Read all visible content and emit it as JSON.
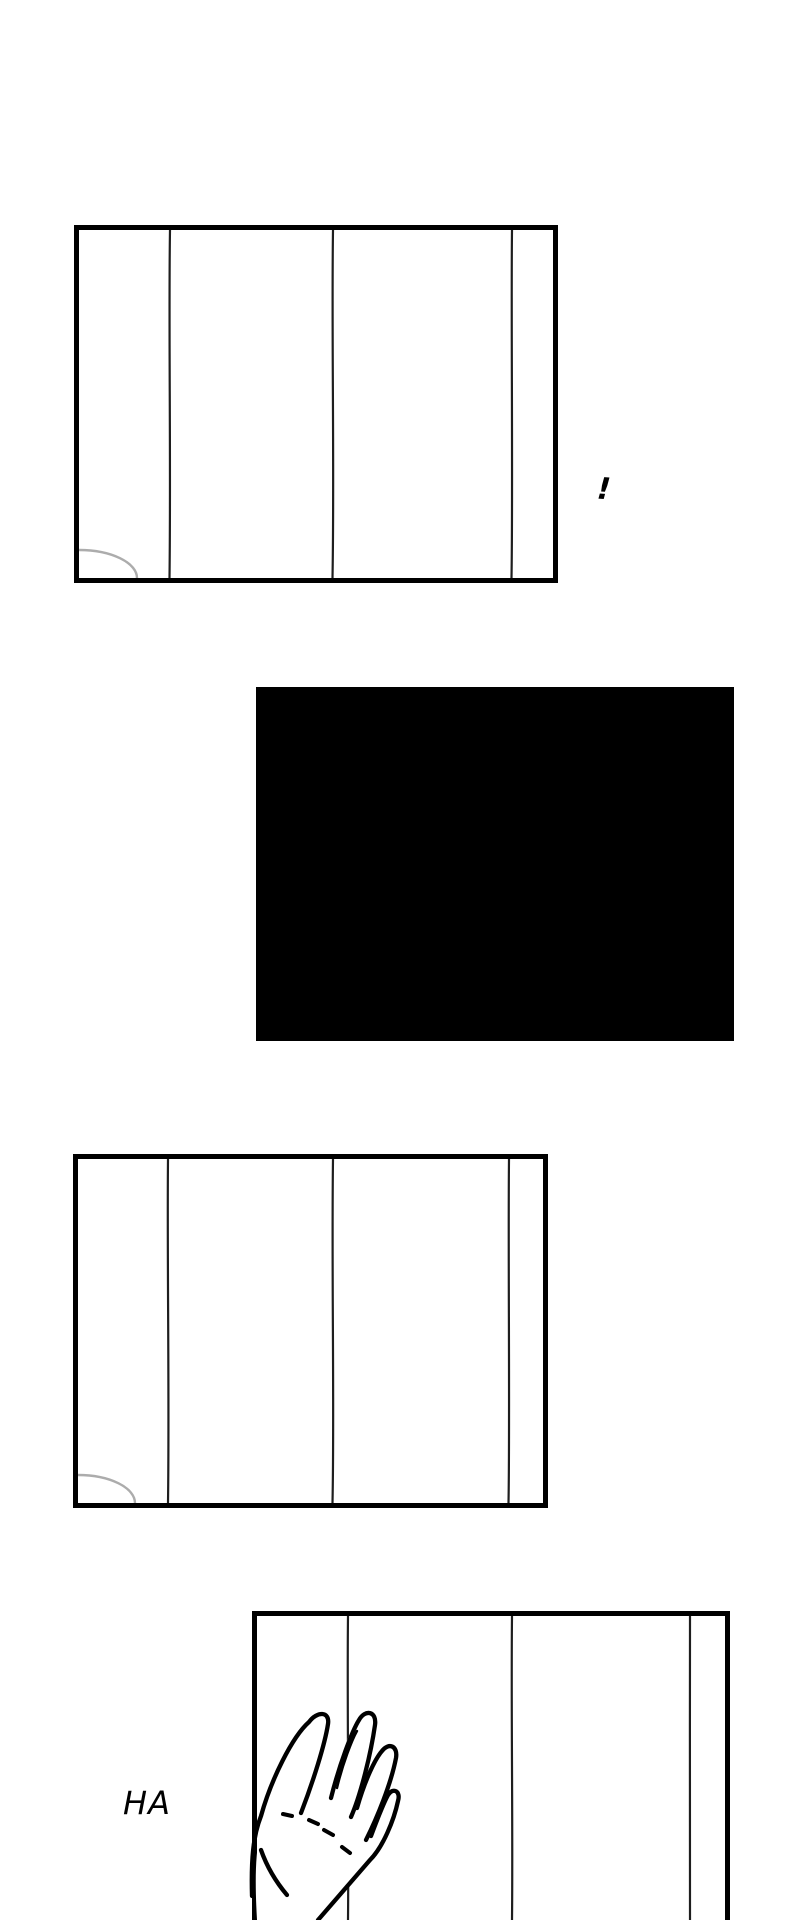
{
  "page": {
    "width_px": 800,
    "height_px": 1920
  },
  "colors": {
    "paper": "#ffffff",
    "ink": "#000000",
    "seam": "#1e1e1e",
    "arc_gray": "#909090"
  },
  "panels": [
    {
      "name": "wall-panel-top",
      "kind": "line-art wall with seams and corner arc"
    },
    {
      "name": "blackout-panel",
      "kind": "solid black"
    },
    {
      "name": "wall-panel-middle",
      "kind": "line-art wall with seams and corner arc"
    },
    {
      "name": "wall-panel-bottom",
      "kind": "line-art wall with hand pressed against it, cut off at page bottom"
    }
  ],
  "sfx": {
    "exclamation": "!",
    "ha": "HA"
  }
}
